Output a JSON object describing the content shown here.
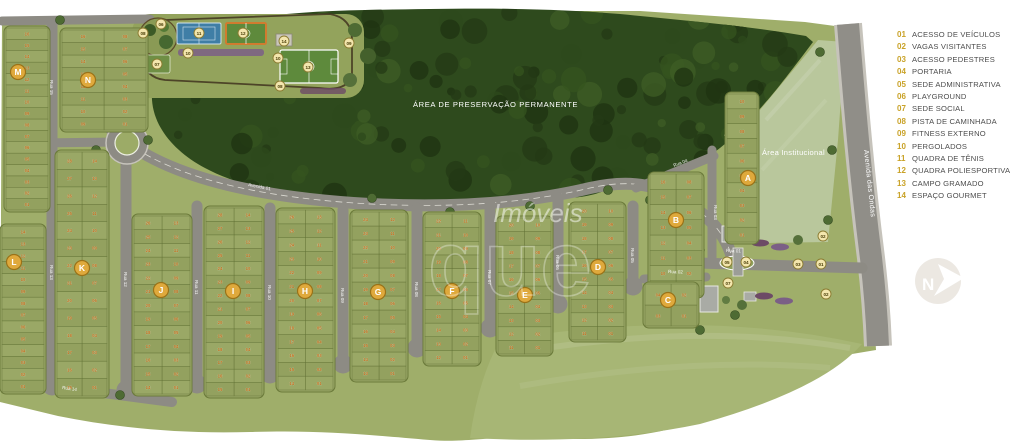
{
  "legend": {
    "items": [
      {
        "num": "01",
        "label": "ACESSO DE VEÍCULOS"
      },
      {
        "num": "02",
        "label": "VAGAS VISITANTES"
      },
      {
        "num": "03",
        "label": "ACESSO PEDESTRES"
      },
      {
        "num": "04",
        "label": "PORTARIA"
      },
      {
        "num": "05",
        "label": "SEDE ADMINISTRATIVA"
      },
      {
        "num": "06",
        "label": "PLAYGROUND"
      },
      {
        "num": "07",
        "label": "SEDE SOCIAL"
      },
      {
        "num": "08",
        "label": "PISTA DE CAMINHADA"
      },
      {
        "num": "09",
        "label": "FITNESS EXTERNO"
      },
      {
        "num": "10",
        "label": "PERGOLADOS"
      },
      {
        "num": "11",
        "label": "QUADRA DE TÊNIS"
      },
      {
        "num": "12",
        "label": "QUADRA POLIESPORTIVA"
      },
      {
        "num": "13",
        "label": "CAMPO GRAMADO"
      },
      {
        "num": "14",
        "label": "ESPAÇO GOURMET"
      }
    ]
  },
  "map": {
    "preservation_label": "ÁREA DE PRESERVAÇÃO PERMANENTE",
    "institutional_label": "Área Institucional",
    "avenue_outer_label": "Avenida das Ondas",
    "watermark": {
      "line1": "Imóveis",
      "line2": "que"
    },
    "logo_letter": "N",
    "colors": {
      "lot_green": "#9aa866",
      "lot_green_alt": "#93a15f",
      "forest": "#2e4a1d",
      "road": "#8d8b84",
      "institutional": "#b9c79c",
      "marker_gold": "#dfa93c",
      "small_marker": "#f3e6ad",
      "lot_number": "#c0701d",
      "legend_gold": "#c9a227"
    },
    "blocks": [
      {
        "label": "M",
        "x": 6,
        "y": 28,
        "w": 42,
        "h": 182,
        "cols": 1,
        "rows": 16,
        "mx": 18,
        "my": 72
      },
      {
        "label": "N",
        "x": 62,
        "y": 30,
        "w": 84,
        "h": 100,
        "cols": 2,
        "rows": 8,
        "mx": 88,
        "my": 80
      },
      {
        "label": "L",
        "x": 2,
        "y": 226,
        "w": 42,
        "h": 166,
        "cols": 1,
        "rows": 14,
        "mx": 14,
        "my": 262
      },
      {
        "label": "K",
        "x": 57,
        "y": 152,
        "w": 50,
        "h": 244,
        "cols": 2,
        "rows": 14,
        "mx": 82,
        "my": 268
      },
      {
        "label": "J",
        "x": 134,
        "y": 216,
        "w": 56,
        "h": 178,
        "cols": 2,
        "rows": 13,
        "mx": 161,
        "my": 290
      },
      {
        "label": "I",
        "x": 206,
        "y": 208,
        "w": 56,
        "h": 188,
        "cols": 2,
        "rows": 14,
        "mx": 233,
        "my": 291
      },
      {
        "label": "H",
        "x": 278,
        "y": 210,
        "w": 55,
        "h": 180,
        "cols": 2,
        "rows": 13,
        "mx": 305,
        "my": 291
      },
      {
        "label": "G",
        "x": 352,
        "y": 212,
        "w": 54,
        "h": 168,
        "cols": 2,
        "rows": 12,
        "mx": 378,
        "my": 292
      },
      {
        "label": "F",
        "x": 425,
        "y": 214,
        "w": 54,
        "h": 150,
        "cols": 2,
        "rows": 11,
        "mx": 452,
        "my": 291
      },
      {
        "label": "E",
        "x": 498,
        "y": 218,
        "w": 53,
        "h": 136,
        "cols": 2,
        "rows": 10,
        "mx": 525,
        "my": 295
      },
      {
        "label": "D",
        "x": 571,
        "y": 204,
        "w": 53,
        "h": 136,
        "cols": 2,
        "rows": 10,
        "mx": 598,
        "my": 267
      },
      {
        "label": "B",
        "x": 650,
        "y": 174,
        "w": 52,
        "h": 122,
        "cols": 2,
        "rows": 8,
        "mx": 676,
        "my": 220
      },
      {
        "label": "A",
        "x": 727,
        "y": 94,
        "w": 30,
        "h": 148,
        "cols": 1,
        "rows": 10,
        "mx": 748,
        "my": 178
      },
      {
        "label": "C",
        "x": 645,
        "y": 284,
        "w": 52,
        "h": 42,
        "cols": 2,
        "rows": 2,
        "mx": 668,
        "my": 300
      }
    ],
    "streets": [
      {
        "x": 52,
        "y1": 24,
        "y2": 388
      },
      {
        "x": 126,
        "y1": 160,
        "y2": 392
      },
      {
        "x": 197,
        "y1": 206,
        "y2": 386
      },
      {
        "x": 270,
        "y1": 208,
        "y2": 376
      },
      {
        "x": 343,
        "y1": 210,
        "y2": 366
      },
      {
        "x": 417,
        "y1": 208,
        "y2": 350
      },
      {
        "x": 490,
        "y1": 204,
        "y2": 330
      },
      {
        "x": 558,
        "y1": 198,
        "y2": 306
      },
      {
        "x": 633,
        "y1": 206,
        "y2": 288
      }
    ],
    "street_labels": [
      {
        "text": "Rua 15",
        "x": 50,
        "y": 80,
        "rot": 90
      },
      {
        "text": "Rua 13",
        "x": 50,
        "y": 265,
        "rot": 90
      },
      {
        "text": "Rua 12",
        "x": 124,
        "y": 272,
        "rot": 90
      },
      {
        "text": "Rua 11",
        "x": 195,
        "y": 280,
        "rot": 90
      },
      {
        "text": "Rua 10",
        "x": 268,
        "y": 285,
        "rot": 90
      },
      {
        "text": "Rua 09",
        "x": 341,
        "y": 288,
        "rot": 90
      },
      {
        "text": "Rua 08",
        "x": 415,
        "y": 282,
        "rot": 90
      },
      {
        "text": "Rua 07",
        "x": 488,
        "y": 270,
        "rot": 90
      },
      {
        "text": "Rua 06",
        "x": 556,
        "y": 255,
        "rot": 90
      },
      {
        "text": "Rua 05",
        "x": 631,
        "y": 248,
        "rot": 90
      },
      {
        "text": "Rua 03",
        "x": 714,
        "y": 205,
        "rot": 90
      },
      {
        "text": "Rua 04",
        "x": 674,
        "y": 167,
        "rot": -21
      },
      {
        "text": "Rua 01",
        "x": 726,
        "y": 252,
        "rot": 2
      },
      {
        "text": "Rua 02",
        "x": 668,
        "y": 273,
        "rot": 2
      },
      {
        "text": "Rua 14",
        "x": 62,
        "y": 389,
        "rot": 8
      },
      {
        "text": "Avenida 01",
        "x": 248,
        "y": 186,
        "rot": 11
      }
    ],
    "amenity_markers": [
      {
        "n": "08",
        "x": 143,
        "y": 33
      },
      {
        "n": "06",
        "x": 161,
        "y": 24
      },
      {
        "n": "07",
        "x": 157,
        "y": 64
      },
      {
        "n": "11",
        "x": 199,
        "y": 33
      },
      {
        "n": "12",
        "x": 243,
        "y": 33
      },
      {
        "n": "10",
        "x": 188,
        "y": 53
      },
      {
        "n": "14",
        "x": 284,
        "y": 41
      },
      {
        "n": "10",
        "x": 278,
        "y": 58
      },
      {
        "n": "09",
        "x": 349,
        "y": 43
      },
      {
        "n": "13",
        "x": 308,
        "y": 67
      },
      {
        "n": "08",
        "x": 280,
        "y": 86
      },
      {
        "n": "05",
        "x": 727,
        "y": 262
      },
      {
        "n": "04",
        "x": 746,
        "y": 262
      },
      {
        "n": "07",
        "x": 728,
        "y": 283
      },
      {
        "n": "02",
        "x": 823,
        "y": 236
      },
      {
        "n": "01",
        "x": 821,
        "y": 264
      },
      {
        "n": "03",
        "x": 798,
        "y": 264
      },
      {
        "n": "02",
        "x": 826,
        "y": 294
      }
    ]
  }
}
